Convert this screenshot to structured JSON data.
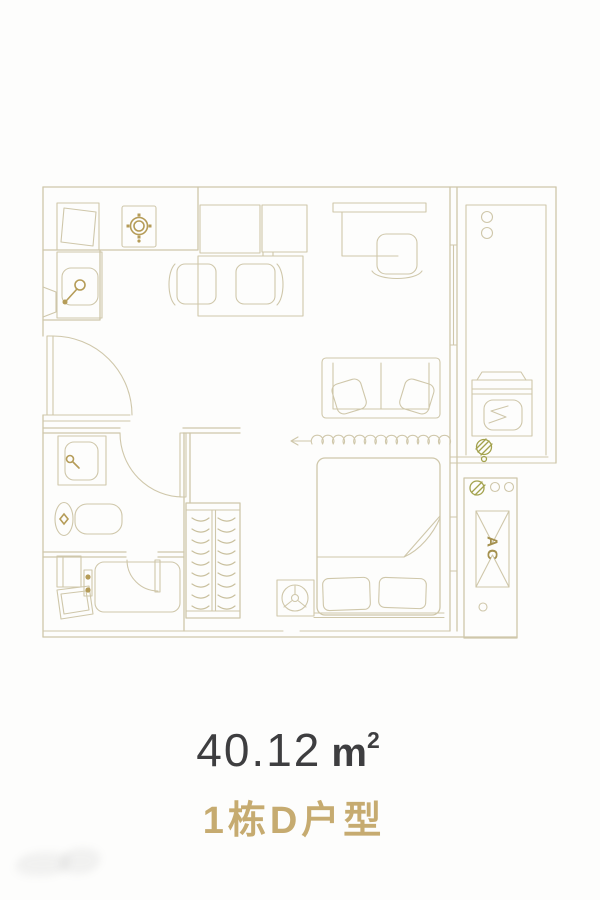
{
  "floorplan": {
    "title": "1栋D户型",
    "area_value": "40.12",
    "area_unit": "m",
    "area_exponent": "2",
    "ac_label": "AC",
    "colors": {
      "line": "#cfc7aa",
      "gold_accent": "#b59c58",
      "drain_accent": "#a3a24e",
      "area_text": "#3e3e40",
      "title_text": "#c6ab70"
    },
    "fixtures": [
      "refrigerator",
      "gas-stove",
      "kitchen-sink",
      "wall-cabinet",
      "wall-cabinet",
      "dining-table",
      "dining-chair",
      "dining-chair",
      "desk",
      "desk-chair",
      "sofa",
      "curtain-divider",
      "double-bed",
      "pillow",
      "pillow",
      "bedside-table",
      "plant",
      "wardrobe",
      "bathroom-vanity",
      "toilet",
      "shower-room",
      "shower-tray",
      "washing-machine",
      "floor-drain",
      "balcony",
      "ac-platform",
      "entry-door",
      "bathroom-door",
      "shower-door"
    ]
  }
}
